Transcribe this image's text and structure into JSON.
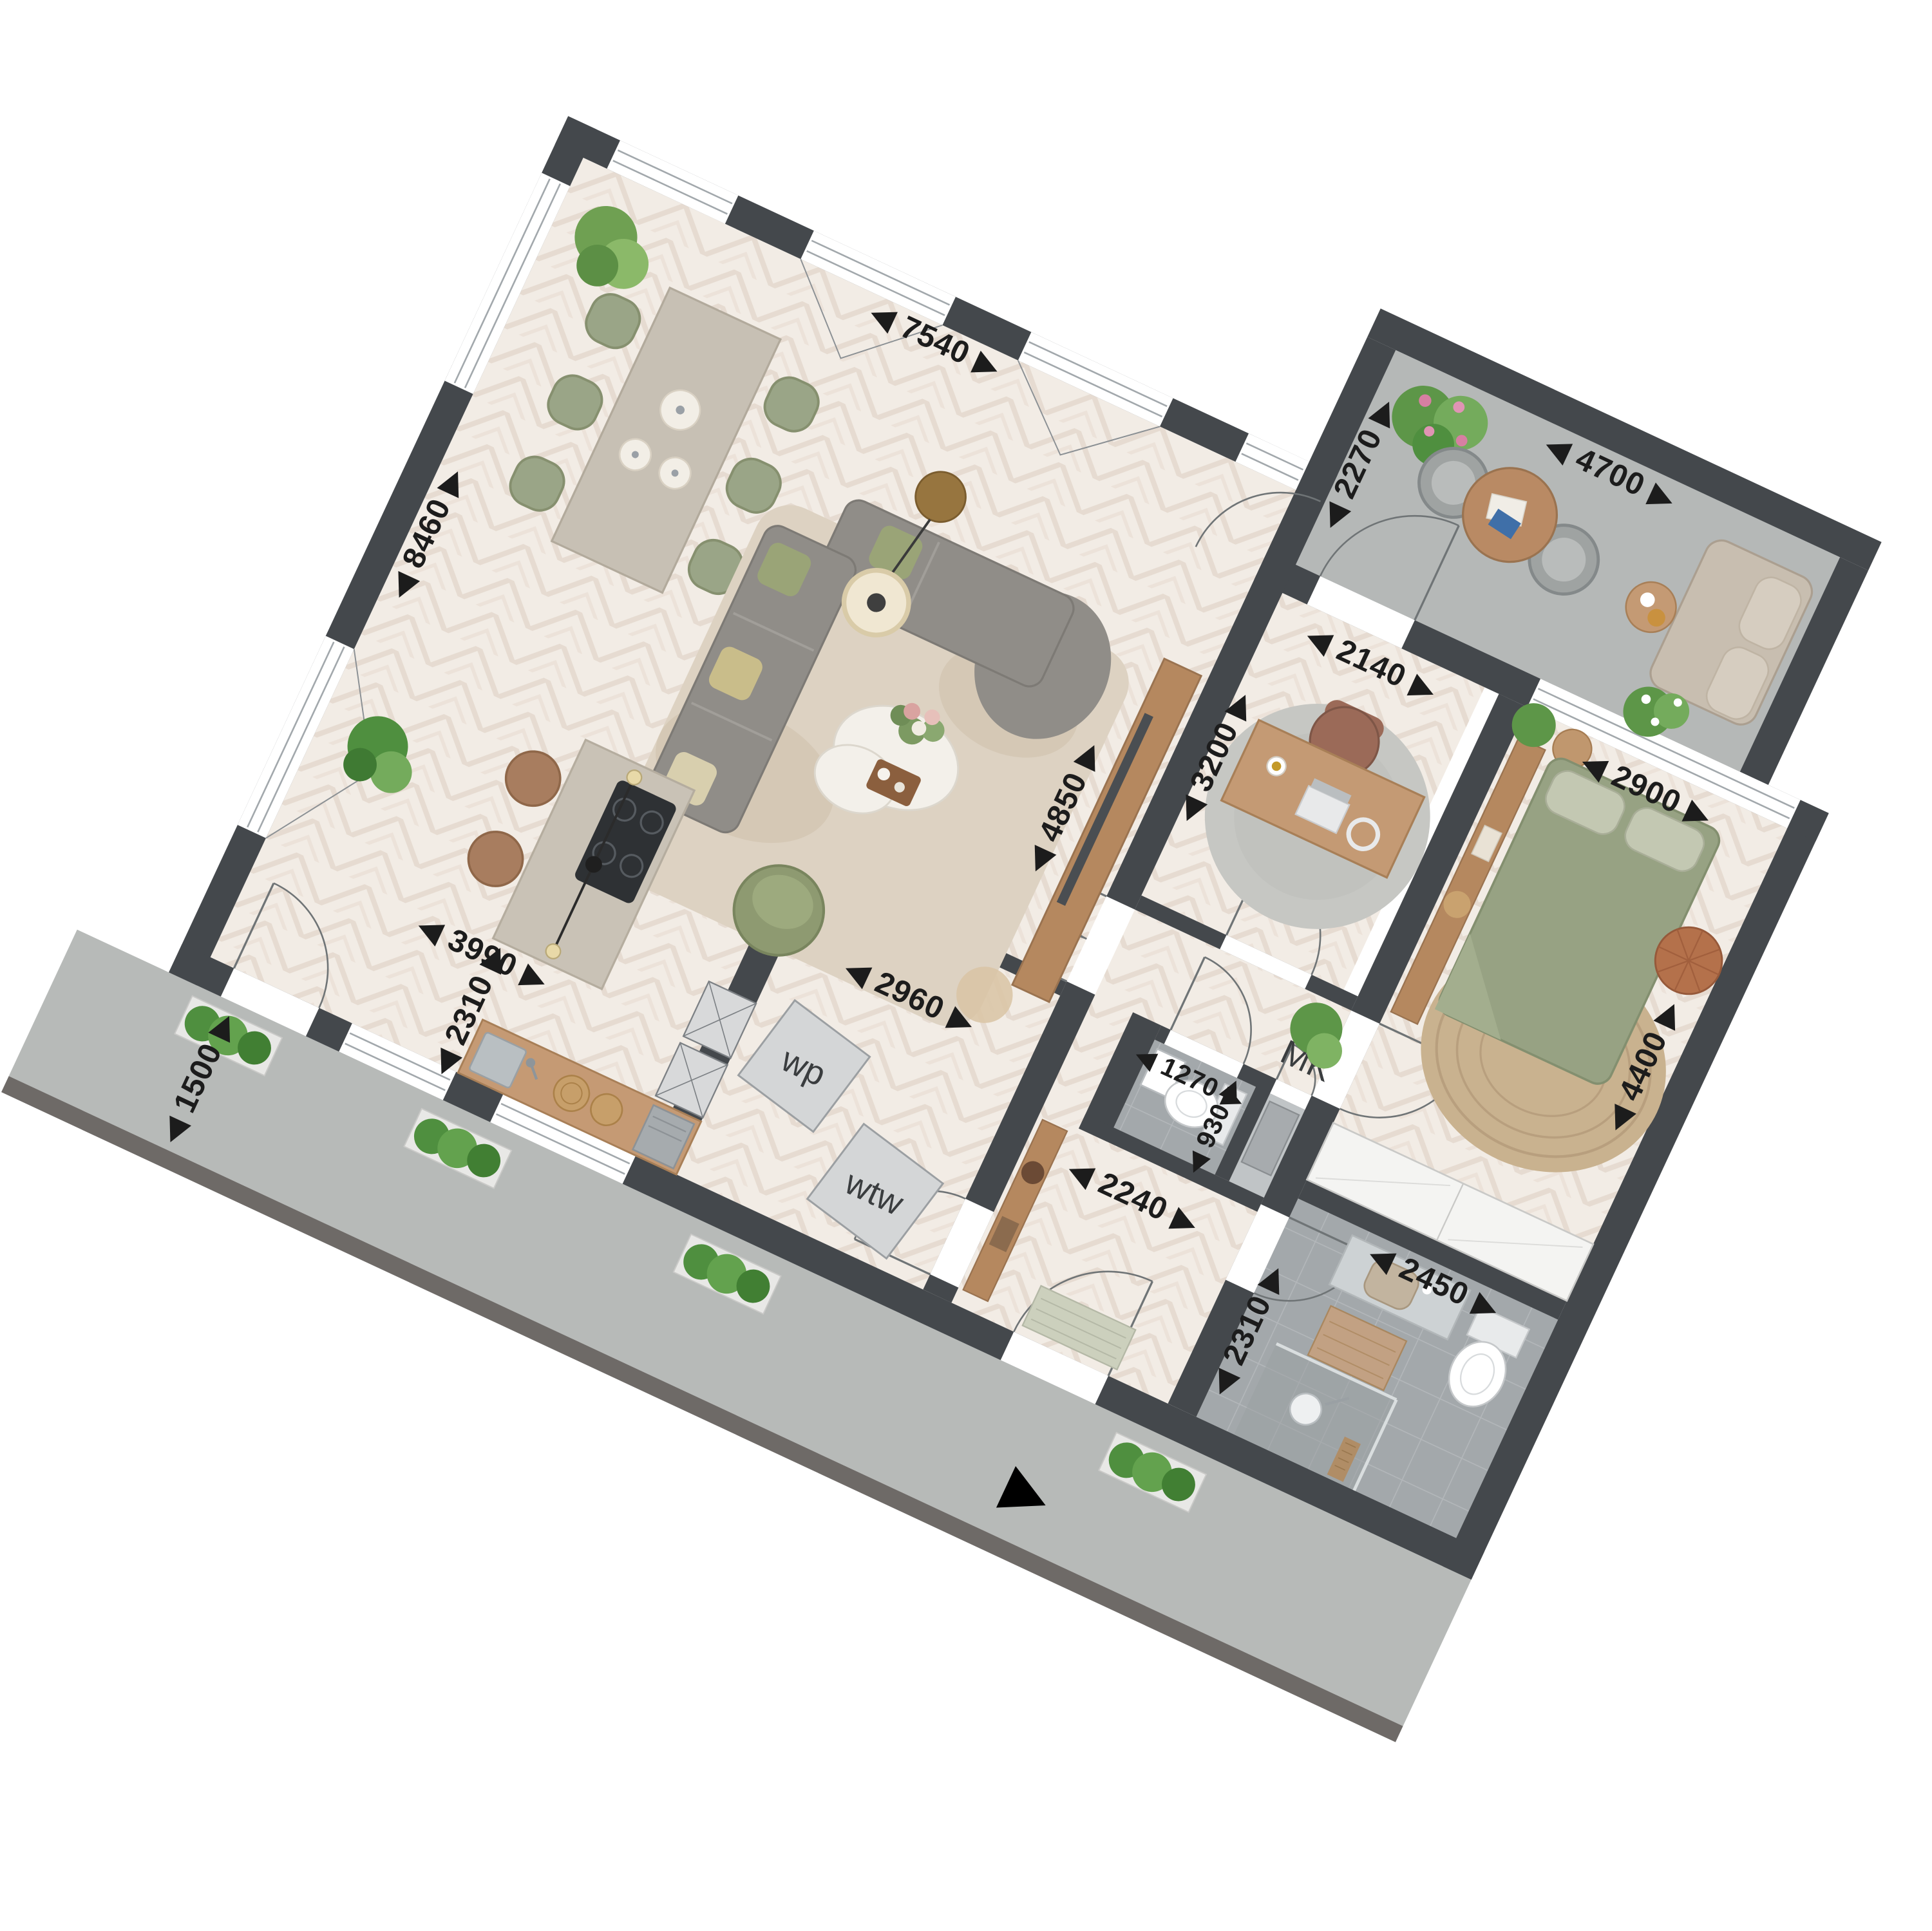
{
  "plan": {
    "title": "apartment-floor-plan",
    "dimensions": {
      "living_top": {
        "value": "7540",
        "display": "◀ 7540 ▶"
      },
      "living_left": {
        "value": "8460",
        "display": "◀ 8460 ▶"
      },
      "kitchen_width": {
        "value": "3990",
        "display": "◀ 3990 ▶"
      },
      "living_right": {
        "value": "4850",
        "display": "◀ 4850 ▶"
      },
      "study_width": {
        "value": "2140",
        "display": "◀ 2140 ▶"
      },
      "study_depth": {
        "value": "3200",
        "display": "◀ 3200 ▶"
      },
      "bedroom_width": {
        "value": "2900",
        "display": "◀ 2900 ▶"
      },
      "bedroom_depth": {
        "value": "4400",
        "display": "◀ 4400 ▶"
      },
      "balcony_depth": {
        "value": "2270",
        "display": "◀ 2270 ▶"
      },
      "balcony_width": {
        "value": "4700",
        "display": "◀ 4700 ▶"
      },
      "counter_length": {
        "value": "2310",
        "display": "◀ 2310 ▶"
      },
      "tech_width": {
        "value": "2960",
        "display": "◀ 2960 ▶"
      },
      "wc_width": {
        "value": "1270",
        "display": "◀ 1270 ▶"
      },
      "wc_depth": {
        "value": "930",
        "display": "◀ 930 ▶"
      },
      "hall_width": {
        "value": "2240",
        "display": "◀ 2240 ▶"
      },
      "terrace_depth": {
        "value": "1500",
        "display": "◀ 1500 ▶"
      },
      "bath_width": {
        "value": "2450",
        "display": "◀ 2450 ▶"
      },
      "bath_depth": {
        "value": "2310",
        "display": "◀ 2310 ▶"
      }
    },
    "labels": {
      "heat_pump": "wp",
      "ventilation": "wtw",
      "meter_cupboard": "MK"
    },
    "colors": {
      "wall": "#44484c",
      "wood_floor": "#f2ece5",
      "concrete": "#b7bab8",
      "tile": "#a3a8ab",
      "bed_green": "#97a283",
      "chair_green": "#9aa587",
      "wood_furniture": "#b5885f"
    }
  }
}
